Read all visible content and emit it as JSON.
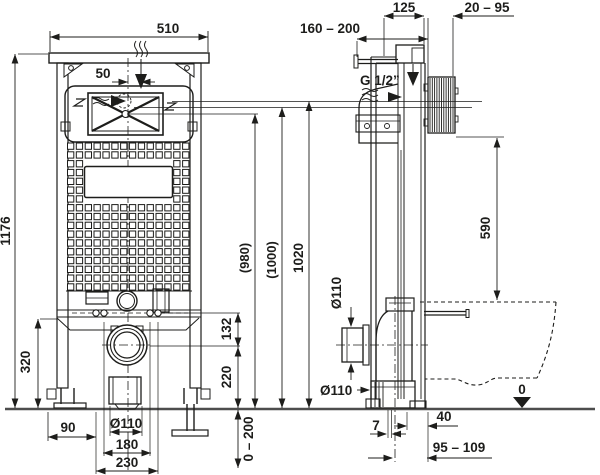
{
  "drawing": {
    "colors": {
      "line": "#1d1d1b",
      "floor": "#4d4d4d",
      "background": "#ffffff"
    },
    "front_view": {
      "width": "510",
      "inlet_offset": "50",
      "frame_height": "1176",
      "height_980": "(980)",
      "height_1000": "(1000)",
      "height_1020": "1020",
      "stud_to_drain": "132",
      "drain_to_floor": "220",
      "lower_zone_height": "320",
      "foot_offset": "90",
      "drain_diameter": "Ø110",
      "stud_spacing": "180",
      "outer_stud_spacing": "230",
      "leg_adjust_range": "0 – 200"
    },
    "side_view": {
      "frame_depth": "125",
      "wall_rod_range": "160 – 200",
      "plate_depth_range": "20 – 95",
      "water_supply": "G 1/2”",
      "cistern_bottom_height": "590",
      "connector_diameter": "Ø110",
      "outlet_diameter": "Ø110",
      "outlet_edge_offset": "7",
      "outlet_front_depth": "40",
      "outlet_wall_distance": "95 – 109",
      "floor_datum": "0"
    }
  }
}
